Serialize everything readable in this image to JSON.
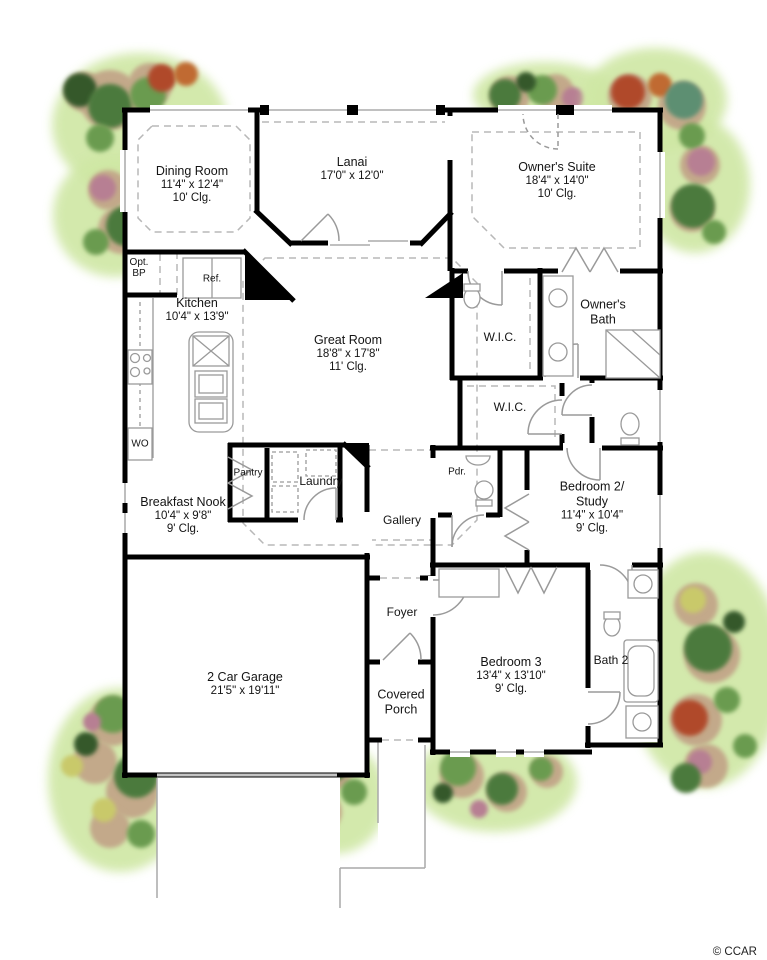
{
  "plan": {
    "copyright": "© CCAR",
    "colors": {
      "wall": "#000000",
      "thin_line": "#9a9a9a",
      "dashed_line": "#b8b8b8",
      "grass": "#cfe7a4",
      "mulch": "#c3a98a",
      "foliage_dark": "#35592c",
      "foliage_mid": "#4c7a3d",
      "foliage_light": "#6a9b4f",
      "bloom_red": "#b0482b",
      "bloom_orange": "#c06a33",
      "bloom_pink": "#b77f93",
      "bloom_yellow": "#c9c96a"
    },
    "rooms": {
      "dining": {
        "name": "Dining Room",
        "dims": "11'4\" x 12'4\"",
        "clg": "10' Clg."
      },
      "lanai": {
        "name": "Lanai",
        "dims": "17'0\" x 12'0\""
      },
      "suite": {
        "name": "Owner's Suite",
        "dims": "18'4\" x 14'0\"",
        "clg": "10' Clg."
      },
      "kitchen": {
        "name": "Kitchen",
        "dims": "10'4\" x 13'9\""
      },
      "great": {
        "name": "Great Room",
        "dims": "18'8\" x 17'8\"",
        "clg": "11' Clg."
      },
      "obath": {
        "name": "Owner's",
        "name2": "Bath"
      },
      "wic1": {
        "name": "W.I.C."
      },
      "wic2": {
        "name": "W.I.C."
      },
      "nook": {
        "name": "Breakfast Nook",
        "dims": "10'4\" x 9'8\"",
        "clg": "9' Clg."
      },
      "pantry": {
        "name": "Pantry"
      },
      "laundry": {
        "name": "Laundry"
      },
      "gallery": {
        "name": "Gallery"
      },
      "powder": {
        "name": "Pdr."
      },
      "bedroom2": {
        "name": "Bedroom 2/",
        "name2": "Study",
        "dims": "11'4\" x 10'4\"",
        "clg": "9' Clg."
      },
      "foyer": {
        "name": "Foyer"
      },
      "garage": {
        "name": "2 Car Garage",
        "dims": "21'5\" x 19'11\""
      },
      "porch": {
        "name": "Covered",
        "name2": "Porch"
      },
      "bedroom3": {
        "name": "Bedroom 3",
        "dims": "13'4\" x 13'10\"",
        "clg": "9' Clg."
      },
      "bath2": {
        "name": "Bath 2"
      },
      "opt_bp": {
        "name": "Opt.",
        "name2": "BP"
      },
      "ref": {
        "name": "Ref."
      },
      "wall_oven": {
        "name": "WO"
      }
    }
  }
}
